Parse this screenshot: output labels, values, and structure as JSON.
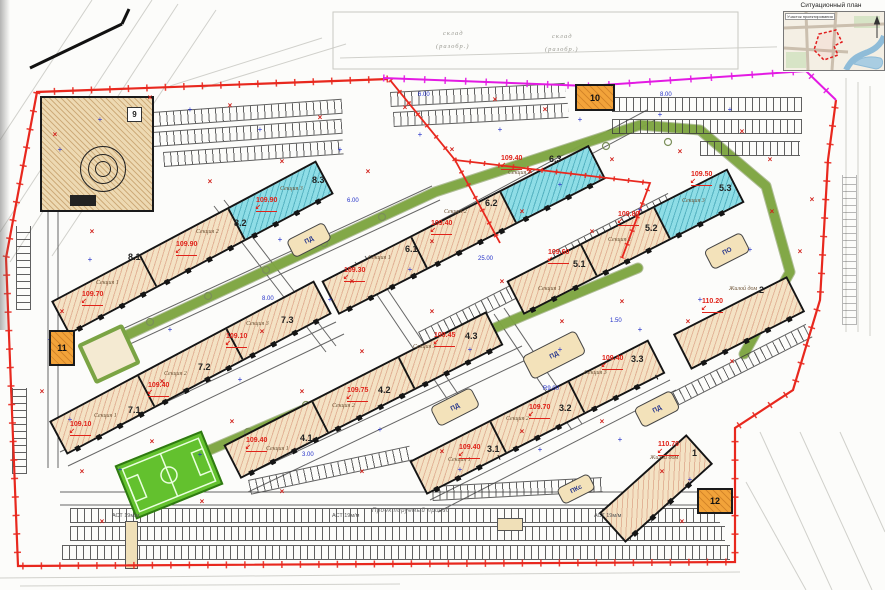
{
  "situational_plan": {
    "title": "Ситуационный план",
    "area_label": "Участок проектирования"
  },
  "boxes": {
    "b9": "9",
    "b10": "10",
    "b11": "11",
    "b12": "12"
  },
  "buildings": [
    {
      "num": "8.1",
      "section": "Секция 1",
      "elev": "109.70"
    },
    {
      "num": "8.2",
      "section": "Секция 2",
      "elev": "109.90"
    },
    {
      "num": "8.3",
      "section": "Секция 3",
      "elev": "109.90"
    },
    {
      "num": "7.1",
      "section": "Секция 1",
      "elev": "109.10"
    },
    {
      "num": "7.2",
      "section": "Секция 2",
      "elev": "109.40"
    },
    {
      "num": "7.3",
      "section": "Секция 3",
      "elev": "109.10"
    },
    {
      "num": "6.1",
      "section": "Секция 1",
      "elev": "109.30"
    },
    {
      "num": "6.2",
      "section": "Секция 2",
      "elev": "109.40"
    },
    {
      "num": "6.3",
      "section": "Секция 3",
      "elev": "109.40"
    },
    {
      "num": "5.1",
      "section": "Секция 1",
      "elev": "109.60"
    },
    {
      "num": "5.2",
      "section": "Секция 2",
      "elev": "109.80"
    },
    {
      "num": "5.3",
      "section": "Секция 3",
      "elev": "109.50"
    },
    {
      "num": "4.1",
      "section": "Секция 1",
      "elev": "109.40"
    },
    {
      "num": "4.2",
      "section": "Секция 2",
      "elev": "109.75"
    },
    {
      "num": "4.3",
      "section": "Секция 3",
      "elev": "109.45"
    },
    {
      "num": "3.1",
      "section": "Секция 1",
      "elev": "109.40"
    },
    {
      "num": "3.2",
      "section": "Секция 2",
      "elev": "109.70"
    },
    {
      "num": "3.3",
      "section": "Секция 3",
      "elev": "109.40"
    },
    {
      "num": "2",
      "section": "Жилой дом",
      "elev": "110.20"
    },
    {
      "num": "1",
      "section": "Жилой дом",
      "elev": "110.70"
    }
  ],
  "site_labels": [
    "ПД",
    "ПО",
    "ПКс"
  ],
  "bg_labels": [
    "склад",
    "(разобр.)",
    "склад",
    "(разобр.)"
  ],
  "parking_labels": [
    "АСТ 19м/м",
    "АСТ 19м/м",
    "АСТ 19м/м"
  ],
  "road_label": "Проектируемый проезд",
  "dim_labels": [
    "6.00",
    "8.00",
    "25.00",
    "R9.00",
    "3.00",
    "1.50",
    "6.00",
    "8.00"
  ]
}
